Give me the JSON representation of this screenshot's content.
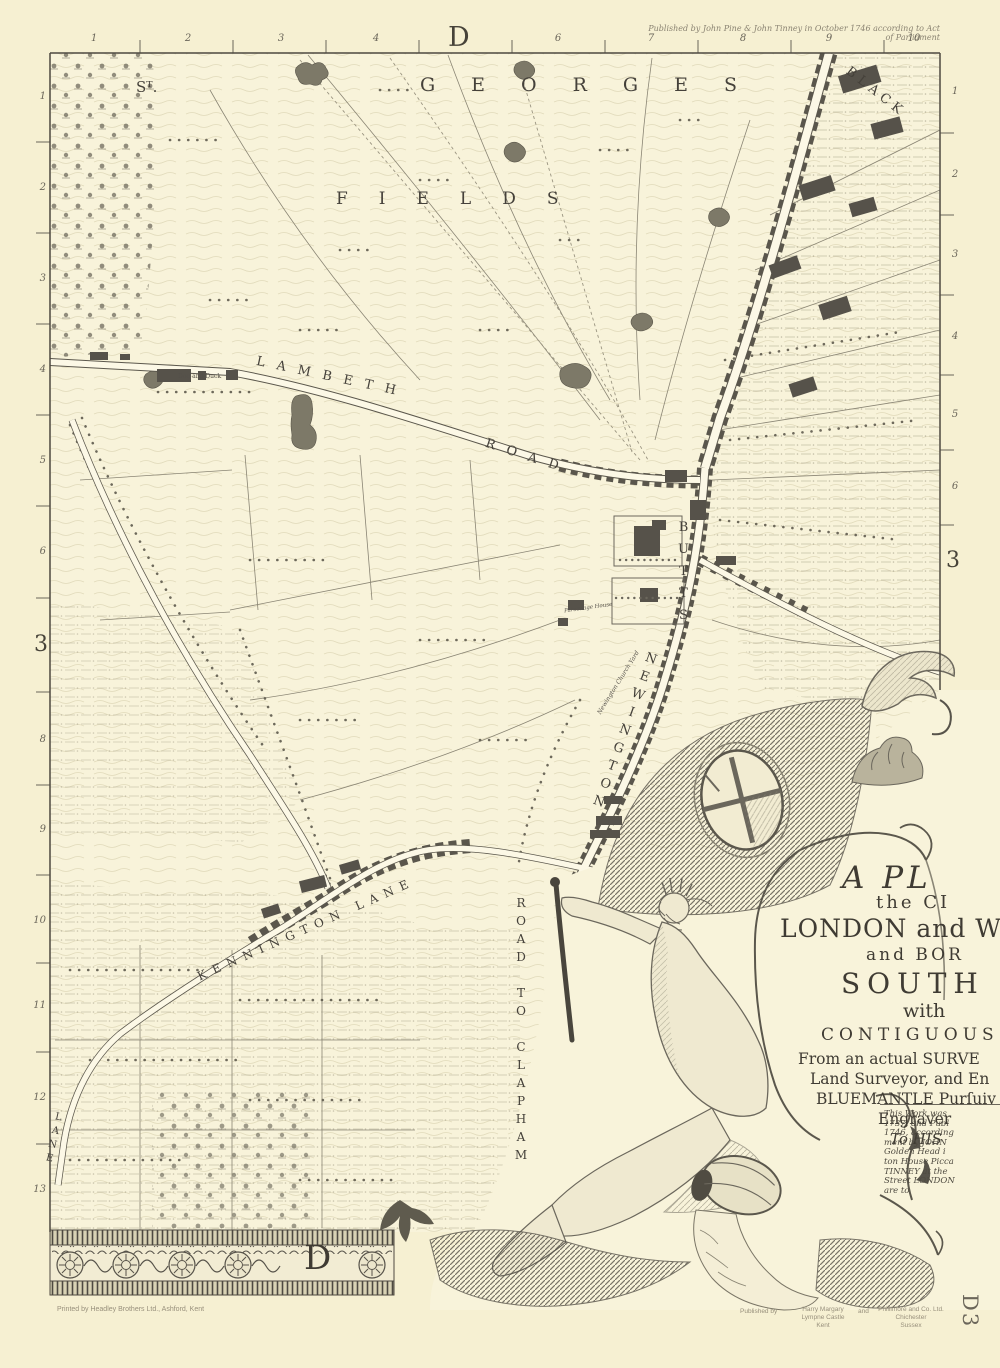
{
  "sheet": {
    "letter": "D",
    "code": "D3",
    "row": "3"
  },
  "header": {
    "imprint": "Published by John Pine & John Tinney in October 1746 according to Act of Parliament"
  },
  "grid": {
    "top_left": [
      "1",
      "2",
      "3",
      "4"
    ],
    "top_right": [
      "6",
      "7",
      "8",
      "9",
      "10"
    ],
    "left_upper": [
      "1",
      "2",
      "3",
      "4",
      "5",
      "6"
    ],
    "left_lower": [
      "8",
      "9",
      "10",
      "11",
      "12",
      "13"
    ],
    "right_upper": [
      "1",
      "2",
      "3",
      "4",
      "5",
      "6"
    ]
  },
  "labels": {
    "st": "Sᵀ.",
    "georges": "GEORGES",
    "fields": "FIELDS",
    "lambeth": "LAMBETH",
    "road": "ROAD",
    "black": "BLACK",
    "butts": "BUTTS",
    "newington": "NEWINGTON",
    "clapham": "ROAD TO CLAPHAM",
    "kennington_lane": "KENNINGTON LANE",
    "lane": "LANE",
    "dog_and_duck": "Dog and Duck",
    "church_yard": "Newington Church Yard",
    "parsonage": "Parsonage House"
  },
  "cartouche": {
    "title_lines": [
      {
        "text": "A PL"
      },
      {
        "text": "the CI"
      },
      {
        "text": "LONDON and W"
      },
      {
        "text": "and BOR"
      },
      {
        "text": "SOUTH"
      },
      {
        "text": "with"
      },
      {
        "text": "CONTIGUOUS"
      },
      {
        "text": "From an actual SURVE"
      },
      {
        "text": "Land Surveyor, and En"
      },
      {
        "text": "BLUEMANTLE Purſuiv"
      },
      {
        "text": "Engraver"
      },
      {
        "text": "To HIS"
      }
    ],
    "note_lines": [
      "This Work was",
      "1737, and Publ",
      "1746, according",
      "ment by JOHN",
      "Golden Head i",
      "ton House Picca",
      "TINNEY at the",
      "Street LONDON",
      "are to"
    ]
  },
  "footer": {
    "printer": "Printed by Headley Brothers Ltd., Ashford, Kent",
    "published_by": "Published by",
    "pub1": [
      "Harry Margary",
      "Lympne Castle",
      "Kent"
    ],
    "and": "and",
    "pub2": [
      "Phillimore and Co. Ltd.",
      "Chichester",
      "Sussex"
    ]
  },
  "colors": {
    "paper": "#f6f0d2",
    "ink": "#4d4840",
    "building": "#56524a"
  }
}
